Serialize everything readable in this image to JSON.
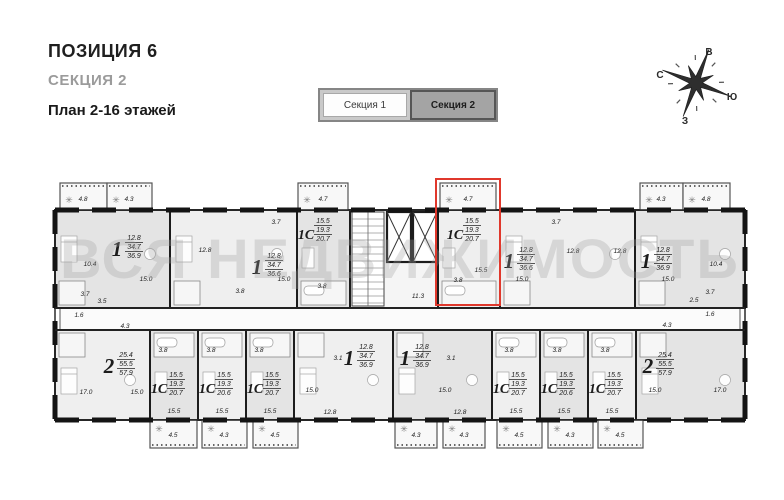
{
  "header": {
    "position": "ПОЗИЦИЯ 6",
    "section": "СЕКЦИЯ 2",
    "plan_label": "План 2-16 этажей"
  },
  "tabs": [
    {
      "label": "Секция 1",
      "active": false
    },
    {
      "label": "Секция 2",
      "active": true
    }
  ],
  "compass": {
    "top": "В",
    "left": "С",
    "right": "Ю",
    "bottom": "З"
  },
  "watermark": "ВСЯ НЕДВИЖИМОСТЬ",
  "colors": {
    "wall": "#1c1c1c",
    "highlight": "#e0382c",
    "unit_fill": "#efefef",
    "unit_fill_alt": "#e4e4e4",
    "balcony_fill": "#f8f8f8",
    "watermark": "#a0a0a0"
  },
  "plan": {
    "outline": {
      "x": 55,
      "y": 210,
      "w": 690,
      "h": 210
    },
    "corridor": {
      "x": 60,
      "y": 308,
      "w": 680,
      "h": 22,
      "label": "11.3",
      "label_x": 418,
      "label_y": 298
    },
    "core": {
      "stairs": {
        "x": 352,
        "y": 212,
        "w": 32,
        "h": 94
      },
      "elevators": [
        {
          "x": 387,
          "y": 212,
          "w": 24,
          "h": 50
        },
        {
          "x": 413,
          "y": 212,
          "w": 24,
          "h": 50
        }
      ]
    },
    "highlight": {
      "x": 436,
      "y": 179,
      "w": 64,
      "h": 126
    },
    "units": [
      {
        "t": "1",
        "a": [
          "12.8",
          "34.7",
          "36.9"
        ],
        "x": 55,
        "y": 210,
        "w": 115,
        "h": 98,
        "lx": 112,
        "ly": 240,
        "shade": true
      },
      {
        "t": "1",
        "a": [
          "12.8",
          "34.7",
          "36.6"
        ],
        "x": 170,
        "y": 210,
        "w": 127,
        "h": 98,
        "lx": 252,
        "ly": 258
      },
      {
        "t": "1С",
        "a": [
          "15.5",
          "19.3",
          "20.7"
        ],
        "x": 297,
        "y": 210,
        "w": 53,
        "h": 98,
        "lx": 301,
        "ly": 223,
        "shade": true
      },
      {
        "t": "1С",
        "a": [
          "15.5",
          "19.3",
          "20.7"
        ],
        "x": 438,
        "y": 210,
        "w": 62,
        "h": 98,
        "lx": 450,
        "ly": 223,
        "hl": true
      },
      {
        "t": "1",
        "a": [
          "12.8",
          "34.7",
          "36.6"
        ],
        "x": 500,
        "y": 210,
        "w": 135,
        "h": 98,
        "lx": 504,
        "ly": 252
      },
      {
        "t": "1",
        "a": [
          "12.8",
          "34.7",
          "36.9"
        ],
        "x": 635,
        "y": 210,
        "w": 110,
        "h": 98,
        "lx": 641,
        "ly": 252,
        "shade": true
      },
      {
        "t": "2",
        "a": [
          "25.4",
          "55.5",
          "57.9"
        ],
        "x": 55,
        "y": 330,
        "w": 95,
        "h": 90,
        "lx": 104,
        "ly": 357
      },
      {
        "t": "1С",
        "a": [
          "15.5",
          "19.3",
          "20.7"
        ],
        "x": 150,
        "y": 330,
        "w": 48,
        "h": 90,
        "lx": 154,
        "ly": 377,
        "shade": true
      },
      {
        "t": "1С",
        "a": [
          "15.5",
          "19.3",
          "20.6"
        ],
        "x": 198,
        "y": 330,
        "w": 48,
        "h": 90,
        "lx": 202,
        "ly": 377
      },
      {
        "t": "1С",
        "a": [
          "15.5",
          "19.3",
          "20.7"
        ],
        "x": 246,
        "y": 330,
        "w": 48,
        "h": 90,
        "lx": 250,
        "ly": 377,
        "shade": true
      },
      {
        "t": "1",
        "a": [
          "12.8",
          "34.7",
          "36.9"
        ],
        "x": 294,
        "y": 330,
        "w": 99,
        "h": 90,
        "lx": 344,
        "ly": 349
      },
      {
        "t": "1",
        "a": [
          "12.8",
          "34.7",
          "36.9"
        ],
        "x": 393,
        "y": 330,
        "w": 99,
        "h": 90,
        "lx": 400,
        "ly": 349,
        "shade": true
      },
      {
        "t": "1С",
        "a": [
          "15.5",
          "19.3",
          "20.7"
        ],
        "x": 492,
        "y": 330,
        "w": 48,
        "h": 90,
        "lx": 496,
        "ly": 377
      },
      {
        "t": "1С",
        "a": [
          "15.5",
          "19.3",
          "20.6"
        ],
        "x": 540,
        "y": 330,
        "w": 48,
        "h": 90,
        "lx": 544,
        "ly": 377,
        "shade": true
      },
      {
        "t": "1С",
        "a": [
          "15.5",
          "19.3",
          "20.7"
        ],
        "x": 588,
        "y": 330,
        "w": 48,
        "h": 90,
        "lx": 592,
        "ly": 377
      },
      {
        "t": "2",
        "a": [
          "25.4",
          "55.5",
          "57.9"
        ],
        "x": 636,
        "y": 330,
        "w": 109,
        "h": 90,
        "lx": 643,
        "ly": 357,
        "shade": true
      }
    ],
    "balconies": [
      {
        "x": 60,
        "y": 183,
        "w": 47,
        "h": 27,
        "label": "4.8",
        "lx": 83,
        "ly": 201
      },
      {
        "x": 107,
        "y": 183,
        "w": 45,
        "h": 27,
        "label": "4.3",
        "lx": 129,
        "ly": 201
      },
      {
        "x": 298,
        "y": 183,
        "w": 50,
        "h": 27,
        "label": "4.7",
        "lx": 323,
        "ly": 201
      },
      {
        "x": 440,
        "y": 183,
        "w": 56,
        "h": 27,
        "label": "4.7",
        "lx": 468,
        "ly": 201
      },
      {
        "x": 640,
        "y": 183,
        "w": 43,
        "h": 27,
        "label": "4.3",
        "lx": 661,
        "ly": 201
      },
      {
        "x": 683,
        "y": 183,
        "w": 47,
        "h": 27,
        "label": "4.8",
        "lx": 706,
        "ly": 201
      },
      {
        "x": 150,
        "y": 420,
        "w": 47,
        "h": 28,
        "label": "4.5",
        "lx": 173,
        "ly": 437
      },
      {
        "x": 202,
        "y": 420,
        "w": 45,
        "h": 28,
        "label": "4.3",
        "lx": 224,
        "ly": 437
      },
      {
        "x": 253,
        "y": 420,
        "w": 45,
        "h": 28,
        "label": "4.5",
        "lx": 275,
        "ly": 437
      },
      {
        "x": 395,
        "y": 420,
        "w": 42,
        "h": 28,
        "label": "4.3",
        "lx": 416,
        "ly": 437
      },
      {
        "x": 443,
        "y": 420,
        "w": 42,
        "h": 28,
        "label": "4.3",
        "lx": 464,
        "ly": 437
      },
      {
        "x": 497,
        "y": 420,
        "w": 45,
        "h": 28,
        "label": "4.5",
        "lx": 519,
        "ly": 437
      },
      {
        "x": 548,
        "y": 420,
        "w": 45,
        "h": 28,
        "label": "4.3",
        "lx": 570,
        "ly": 437
      },
      {
        "x": 598,
        "y": 420,
        "w": 45,
        "h": 28,
        "label": "4.5",
        "lx": 620,
        "ly": 437
      }
    ],
    "room_labels": [
      {
        "t": "10.4",
        "x": 90,
        "y": 266
      },
      {
        "t": "15.0",
        "x": 146,
        "y": 281
      },
      {
        "t": "3.7",
        "x": 85,
        "y": 296
      },
      {
        "t": "3.5",
        "x": 102,
        "y": 303
      },
      {
        "t": "1.6",
        "x": 79,
        "y": 317
      },
      {
        "t": "12.8",
        "x": 205,
        "y": 252
      },
      {
        "t": "15.0",
        "x": 284,
        "y": 281
      },
      {
        "t": "3.7",
        "x": 276,
        "y": 224
      },
      {
        "t": "3.8",
        "x": 240,
        "y": 293
      },
      {
        "t": "3.8",
        "x": 322,
        "y": 288
      },
      {
        "t": "3.8",
        "x": 458,
        "y": 282
      },
      {
        "t": "15.5",
        "x": 481,
        "y": 272
      },
      {
        "t": "12.8",
        "x": 573,
        "y": 253
      },
      {
        "t": "15.0",
        "x": 522,
        "y": 281
      },
      {
        "t": "3.7",
        "x": 556,
        "y": 224
      },
      {
        "t": "12.8",
        "x": 620,
        "y": 253
      },
      {
        "t": "15.0",
        "x": 668,
        "y": 281
      },
      {
        "t": "10.4",
        "x": 716,
        "y": 266
      },
      {
        "t": "3.7",
        "x": 710,
        "y": 294
      },
      {
        "t": "2.5",
        "x": 694,
        "y": 302
      },
      {
        "t": "1.6",
        "x": 710,
        "y": 316
      },
      {
        "t": "4.3",
        "x": 125,
        "y": 328
      },
      {
        "t": "4.3",
        "x": 667,
        "y": 327
      },
      {
        "t": "17.0",
        "x": 86,
        "y": 394
      },
      {
        "t": "15.0",
        "x": 137,
        "y": 394
      },
      {
        "t": "3.8",
        "x": 163,
        "y": 352
      },
      {
        "t": "3.8",
        "x": 211,
        "y": 352
      },
      {
        "t": "3.8",
        "x": 259,
        "y": 352
      },
      {
        "t": "3.8",
        "x": 509,
        "y": 352
      },
      {
        "t": "3.8",
        "x": 557,
        "y": 352
      },
      {
        "t": "3.8",
        "x": 605,
        "y": 352
      },
      {
        "t": "15.5",
        "x": 174,
        "y": 413
      },
      {
        "t": "15.5",
        "x": 222,
        "y": 413
      },
      {
        "t": "15.5",
        "x": 270,
        "y": 413
      },
      {
        "t": "15.5",
        "x": 516,
        "y": 413
      },
      {
        "t": "15.5",
        "x": 564,
        "y": 413
      },
      {
        "t": "15.5",
        "x": 612,
        "y": 413
      },
      {
        "t": "3.1",
        "x": 338,
        "y": 360
      },
      {
        "t": "15.0",
        "x": 312,
        "y": 392
      },
      {
        "t": "12.8",
        "x": 330,
        "y": 414
      },
      {
        "t": "3.1",
        "x": 451,
        "y": 360
      },
      {
        "t": "15.0",
        "x": 445,
        "y": 392
      },
      {
        "t": "12.8",
        "x": 460,
        "y": 414
      },
      {
        "t": "15.0",
        "x": 655,
        "y": 392
      },
      {
        "t": "17.0",
        "x": 720,
        "y": 392
      }
    ]
  }
}
